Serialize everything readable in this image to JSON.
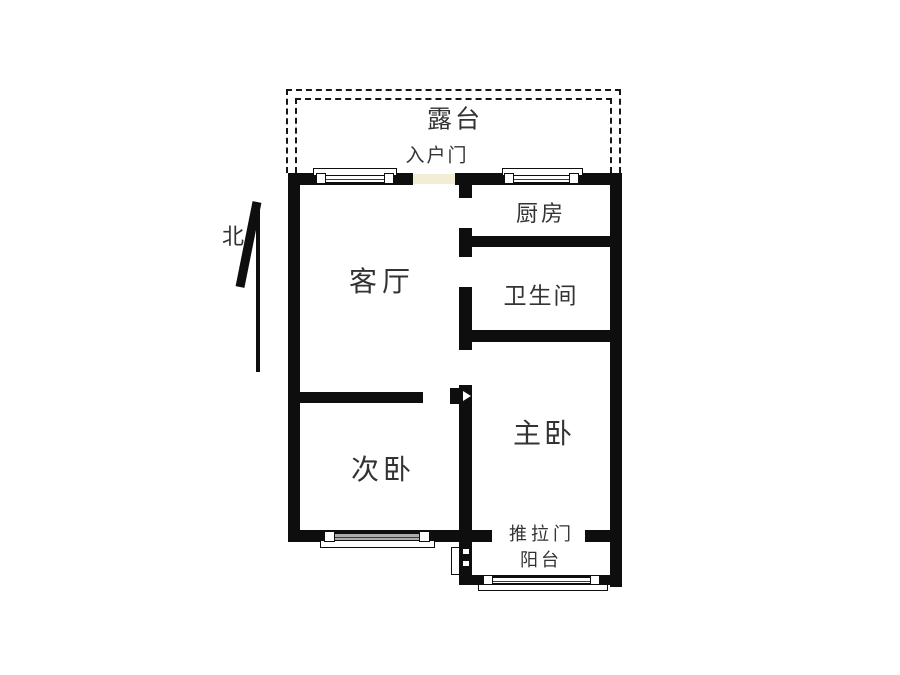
{
  "plan": {
    "compass_north": "北",
    "rooms": {
      "terrace": "露台",
      "entrance_door": "入户门",
      "kitchen": "厨房",
      "living_room": "客厅",
      "bathroom": "卫生间",
      "master_bedroom": "主卧",
      "second_bedroom": "次卧",
      "sliding_door": "推拉门",
      "balcony": "阳台"
    }
  },
  "colors": {
    "wall": "#0e0e0e",
    "label_text": "#333333",
    "entrance_door_fill": "#f2edd5",
    "window_gray_fill": "#ababab",
    "dash_outline": "#161616",
    "background": "#ffffff"
  }
}
